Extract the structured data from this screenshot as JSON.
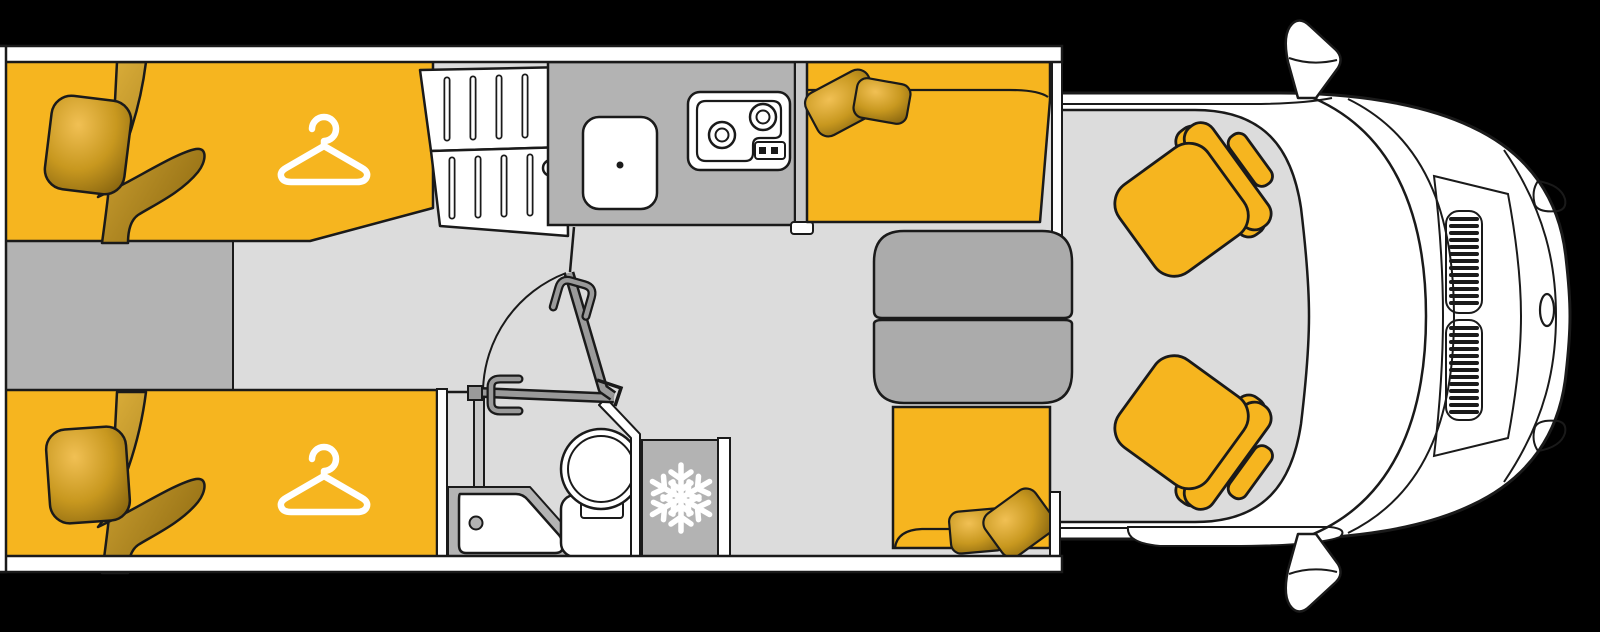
{
  "scene": {
    "description": "Top-down floor plan of a motorhome / campervan",
    "view": "top-down",
    "vehicle_orientation": "cab-right"
  },
  "colors": {
    "background": "#000000",
    "line": "#1a1a1a",
    "body": "#ffffff",
    "floor": "#dcdcdc",
    "surface_dark": "#b3b3b3",
    "wall_light": "#c9c9c9",
    "table": "#ababab",
    "upholstery": "#f6b51f",
    "door": "#9a9a9a",
    "icon_white": "#ffffff",
    "pillow_hi": "#f1c054",
    "pillow_mid": "#c8981f",
    "pillow_lo": "#7a5a0c",
    "blanket_hi": "#e0b23c",
    "blanket_lo": "#8a660e",
    "knob_dark": "#1a1a1a"
  },
  "zones": {
    "bedroom": {
      "name": "rear twin single beds",
      "beds": 2,
      "symbols": [
        "hanger-icon",
        "hanger-icon"
      ]
    },
    "wardrobe": {
      "name": "slatted cabinet between beds and kitchen"
    },
    "kitchen": {
      "name": "kitchenette",
      "equipment": [
        "sink",
        "two-burner hob"
      ]
    },
    "bathroom": {
      "name": "washroom",
      "equipment": [
        "shower tray",
        "toilet",
        "pivoting door"
      ]
    },
    "fridge": {
      "name": "refrigerator",
      "symbol": "snowflake-icon"
    },
    "dinette": {
      "name": "half dinette",
      "equipment": [
        "bench seat front",
        "bench seat rear",
        "split folding table"
      ]
    },
    "cab": {
      "name": "driver cab",
      "equipment": [
        "swivel seat left",
        "swivel seat right",
        "windshield",
        "mirror top",
        "mirror bottom",
        "hood vents",
        "headlights",
        "emblem"
      ]
    }
  },
  "icons": [
    {
      "name": "hanger-icon",
      "meaning": "wardrobe / clothes storage",
      "count": 2
    },
    {
      "name": "snowflake-icon",
      "meaning": "refrigerator",
      "count": 1
    }
  ]
}
